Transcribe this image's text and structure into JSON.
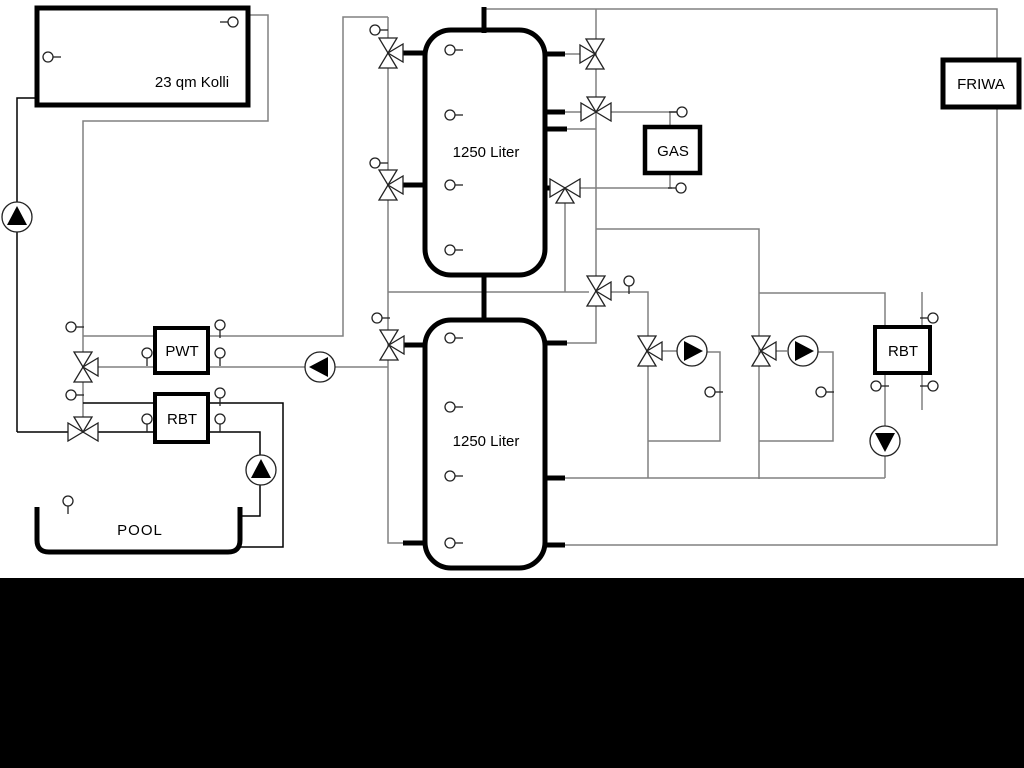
{
  "colors": {
    "background": "#ffffff",
    "pipe_gray": "#808080",
    "pipe_black": "#000000",
    "box_fill": "#ffffff",
    "footer_band": "#000000"
  },
  "labels": {
    "collector": "23 qm Kolli",
    "tank_top": "1250 Liter",
    "tank_bottom": "1250 Liter",
    "pwt": "PWT",
    "rbt_left": "RBT",
    "rbt_right": "RBT",
    "gas": "GAS",
    "friwa": "FRIWA",
    "pool": "POOL"
  },
  "icons": {
    "valve": "three-way-valve-icon",
    "pump": "pump-icon",
    "sensor": "temperature-sensor-icon"
  }
}
